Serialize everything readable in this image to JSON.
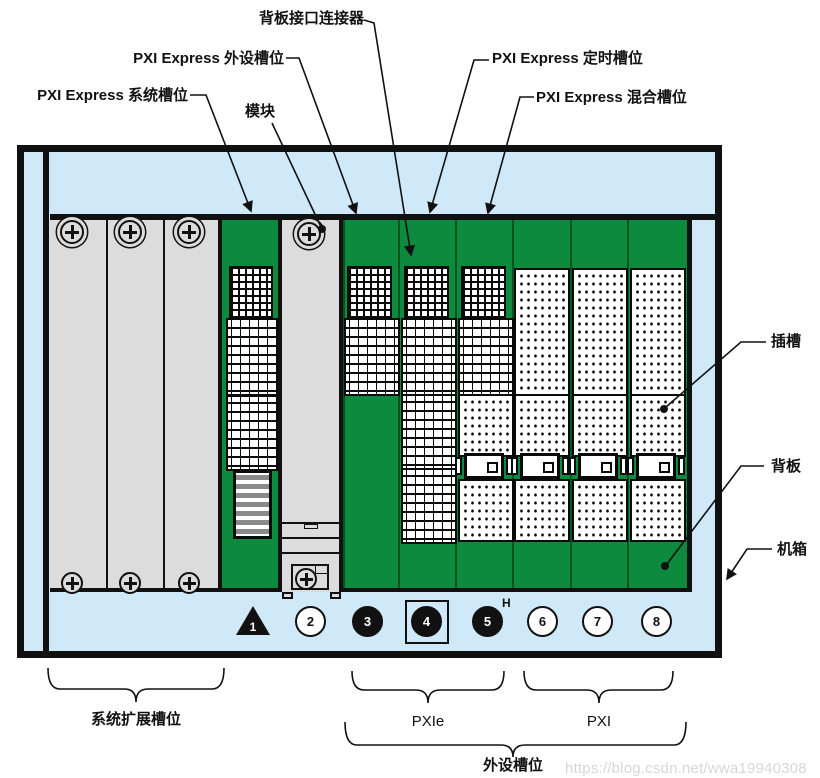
{
  "figure": {
    "callouts": {
      "backplane_connector": "背板接口连接器",
      "peripheral_slot": "PXI Express 外设槽位",
      "system_slot": "PXI Express 系统槽位",
      "module": "模块",
      "timing_slot": "PXI Express 定时槽位",
      "hybrid_slot": "PXI Express 混合槽位",
      "slot": "插槽",
      "backplane": "背板",
      "chassis": "机箱"
    },
    "groups": {
      "system_expansion": "系统扩展槽位",
      "pxie": "PXIe",
      "pxi": "PXI",
      "peripheral": "外设槽位"
    },
    "slot_markers": [
      {
        "number": "1",
        "shape": "triangle",
        "style": "filled"
      },
      {
        "number": "2",
        "shape": "circle",
        "style": "open"
      },
      {
        "number": "3",
        "shape": "circle",
        "style": "filled"
      },
      {
        "number": "4",
        "shape": "circle-in-square",
        "style": "filled"
      },
      {
        "number": "5",
        "shape": "circle",
        "style": "filled",
        "superscript": "H"
      },
      {
        "number": "6",
        "shape": "circle",
        "style": "open"
      },
      {
        "number": "7",
        "shape": "circle",
        "style": "open"
      },
      {
        "number": "8",
        "shape": "circle",
        "style": "open"
      }
    ],
    "colors": {
      "backplane_green": "#0E8A3E",
      "chassis_blue": "#CFE9F8",
      "panel_gray": "#DCDCDC",
      "line_black": "#111111"
    },
    "watermark": "https://blog.csdn.net/wwa19940308"
  }
}
